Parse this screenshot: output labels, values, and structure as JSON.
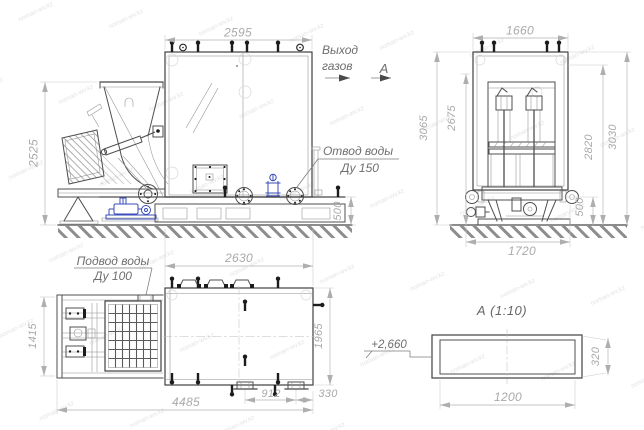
{
  "watermark": {
    "text": "noman-wv.kz"
  },
  "labels": {
    "gas_outlet_line1": "Выход",
    "gas_outlet_line2": "газов",
    "section_mark": "А",
    "water_drain_line1": "Отвод воды",
    "water_drain_line2": "Ду 150",
    "water_supply_line1": "Подвод воды",
    "water_supply_line2": "Ду 100",
    "section_title": "А  (1:10)",
    "elevation_mark": "+2,660"
  },
  "dimensions": {
    "front_view": {
      "width": "2595",
      "height": "2525",
      "base_height": "500"
    },
    "side_view": {
      "width": "1660",
      "overall_height": "3065",
      "inner_height": "2675",
      "frame_height": "2820",
      "total_height": "3030",
      "base_height": "500",
      "base_width": "1720"
    },
    "plan_view": {
      "body_width": "2630",
      "body_depth": "1965",
      "feeder_depth": "1415",
      "overall_length": "4485",
      "support_spacing": "912",
      "support_offset": "330"
    },
    "section_a": {
      "width": "1200",
      "height": "320"
    }
  },
  "colors": {
    "line": "#4f4f4f",
    "dimension": "#ababab",
    "label": "#6e6e6e",
    "hydraulics_accent": "#3b4db8",
    "background": "#ffffff"
  }
}
